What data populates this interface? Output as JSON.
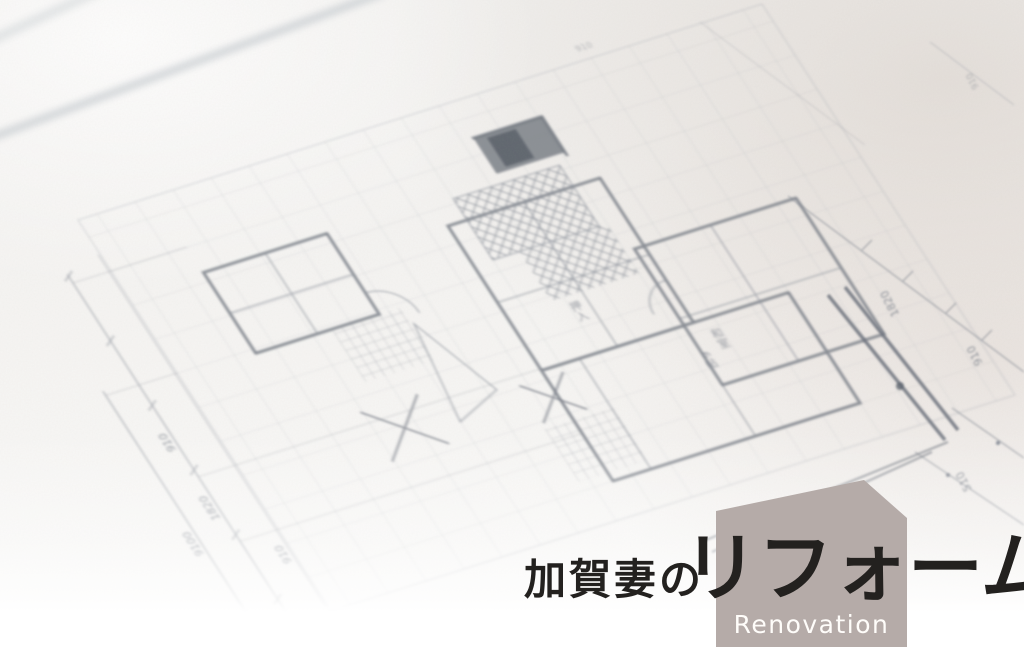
{
  "page": {
    "type": "hero-banner",
    "width": 1024,
    "height": 647
  },
  "hero": {
    "title_prefix": "加賀妻の",
    "title_main": "リフォーム",
    "subtitle": "Renovation",
    "colors": {
      "badge": "#b5aba8",
      "title": "#23211f",
      "subtitle_text": "#fffdfa"
    }
  },
  "blueprint": {
    "kind": "hand-drawn floor plan photograph, soft focus, rotated on desk",
    "dimensions": {
      "left": [
        "910",
        "1820",
        "9100",
        "910"
      ],
      "right": [
        "1820",
        "910",
        "510"
      ],
      "top": [
        "910"
      ]
    },
    "room_labels": [
      "押入",
      "和室",
      "6帖"
    ],
    "colors": {
      "paper": "#f5f4f2",
      "ink": "#868c96",
      "wall": "#6e747e"
    }
  }
}
